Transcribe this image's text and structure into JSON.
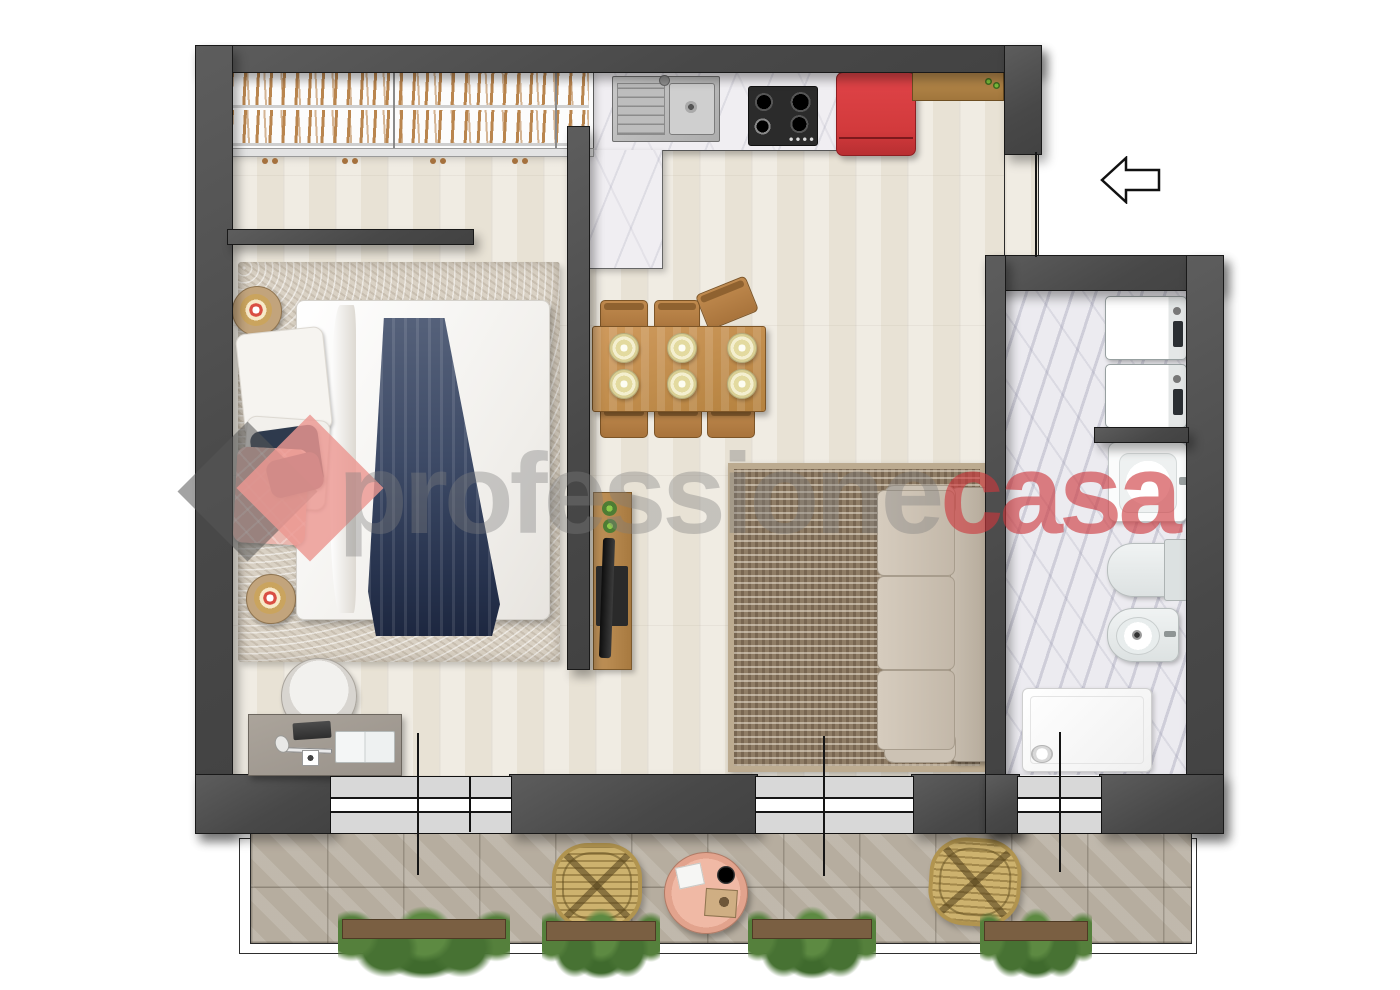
{
  "watermark": {
    "text_gray": "professione",
    "text_accent": "casa",
    "logo": {
      "diamond_left_color": "#5a5a5a",
      "diamond_right_color": "#ec9791"
    },
    "accent_color": "#cd373c"
  },
  "plan": {
    "type": "apartment-floor-plan-top-view",
    "entrance_arrow_direction": "left",
    "rooms": [
      "bedroom",
      "kitchen-living-room",
      "bathroom",
      "terrace"
    ],
    "bedroom_items": [
      "wardrobe-with-hangers",
      "area-rug",
      "double-bed",
      "navy-throw",
      "pillows",
      "nightstand-with-lamp",
      "nightstand-with-lamp",
      "desk",
      "desk-chair",
      "laptop",
      "open-book"
    ],
    "kitchen_living_items": [
      "kitchen-counter",
      "double-sink",
      "gas-hob-4-burners",
      "red-refrigerator",
      "wood-shelf-with-plants",
      "dining-table",
      "six-chairs",
      "six-plates",
      "tv-console-with-plants",
      "patterned-rug",
      "three-seat-sofa"
    ],
    "bathroom_items": [
      "washing-machine",
      "washing-machine",
      "washbasin",
      "toilet",
      "bidet",
      "shower-tray"
    ],
    "terrace_items": [
      "rattan-chair",
      "rattan-chair",
      "round-coffee-table",
      "planter",
      "planter",
      "planter",
      "planter"
    ]
  },
  "colors": {
    "wall": "#4f4f4f",
    "wood_floor": "#e8e2d5",
    "marble": "#f0eef2",
    "terrace_tile": "#b6ad9f",
    "fridge_red": "#d23a3c",
    "rug_brown": "#8f7d66",
    "plant_green": "#55803c",
    "rattan": "#cdb26e"
  }
}
